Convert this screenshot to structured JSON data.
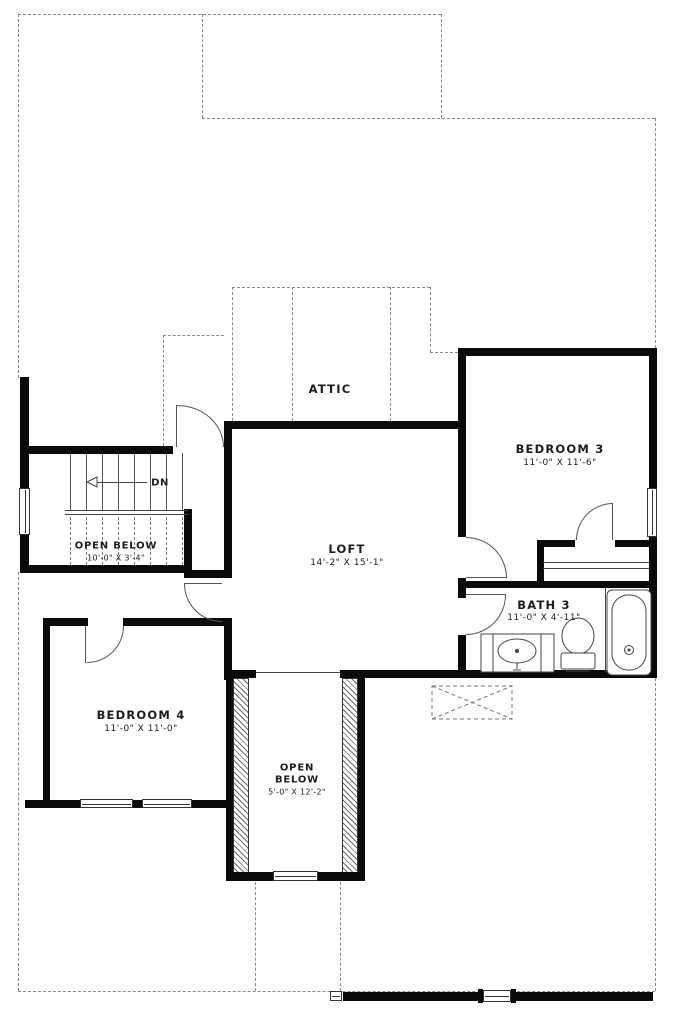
{
  "plan": {
    "rooms": {
      "attic": {
        "label": "ATTIC"
      },
      "bedroom3": {
        "label": "BEDROOM 3",
        "dims": "11'-0\" X 11'-6\""
      },
      "loft": {
        "label": "LOFT",
        "dims": "14'-2\" X 15'-1\""
      },
      "stair_open_below": {
        "label": "OPEN BELOW",
        "dims": "10'-0\" X 3'-4\""
      },
      "bath3": {
        "label": "BATH 3",
        "dims": "11'-0\" X 4'-11\""
      },
      "bedroom4": {
        "label": "BEDROOM 4",
        "dims": "11'-0\" X 11'-0\""
      },
      "shaft_open_below": {
        "line1": "OPEN",
        "line2": "BELOW",
        "dims": "5'-0\" X 12'-2\""
      }
    },
    "stairs": {
      "down_label": "DN"
    },
    "colors": {
      "wall": "#0a0a0a",
      "thin_line": "#444444",
      "dashed_line": "#8a8a8a",
      "background": "#ffffff",
      "text": "#1c1c1c"
    }
  }
}
